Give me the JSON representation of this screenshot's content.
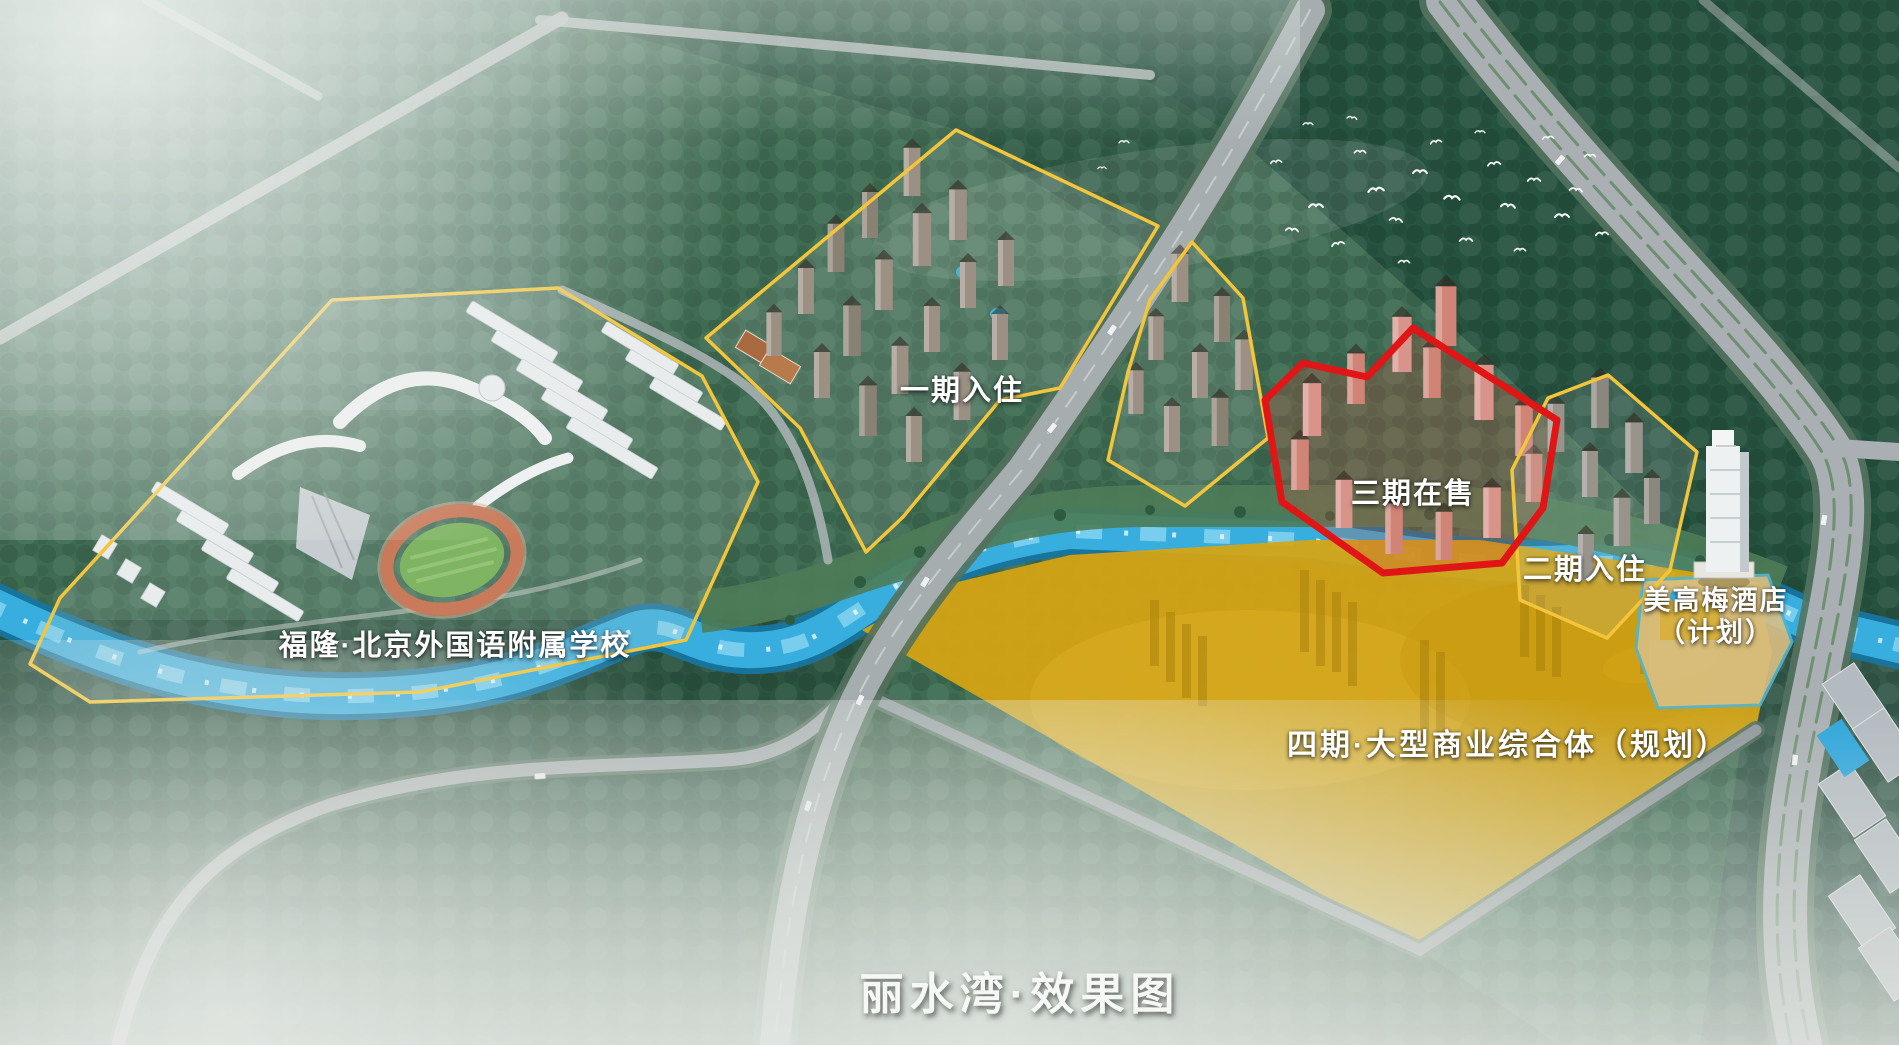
{
  "page": {
    "title": "丽水湾·效果图"
  },
  "zones": {
    "school": {
      "label": "福隆·北京外国语附属学校"
    },
    "phase1": {
      "label": "一期入住"
    },
    "phase2": {
      "label": "二期入住"
    },
    "phase3": {
      "label": "三期在售"
    },
    "phase4": {
      "label": "四期·大型商业综合体（规划）"
    },
    "hotel": {
      "label_line1": "美高梅酒店",
      "label_line2": "（计划）"
    }
  },
  "colors": {
    "zone_outline_yellow": "#f2c53a",
    "zone_outline_red": "#e01616",
    "phase4_fill": "#d7a512",
    "river": "#38aede",
    "label_text": "#ffffff"
  }
}
